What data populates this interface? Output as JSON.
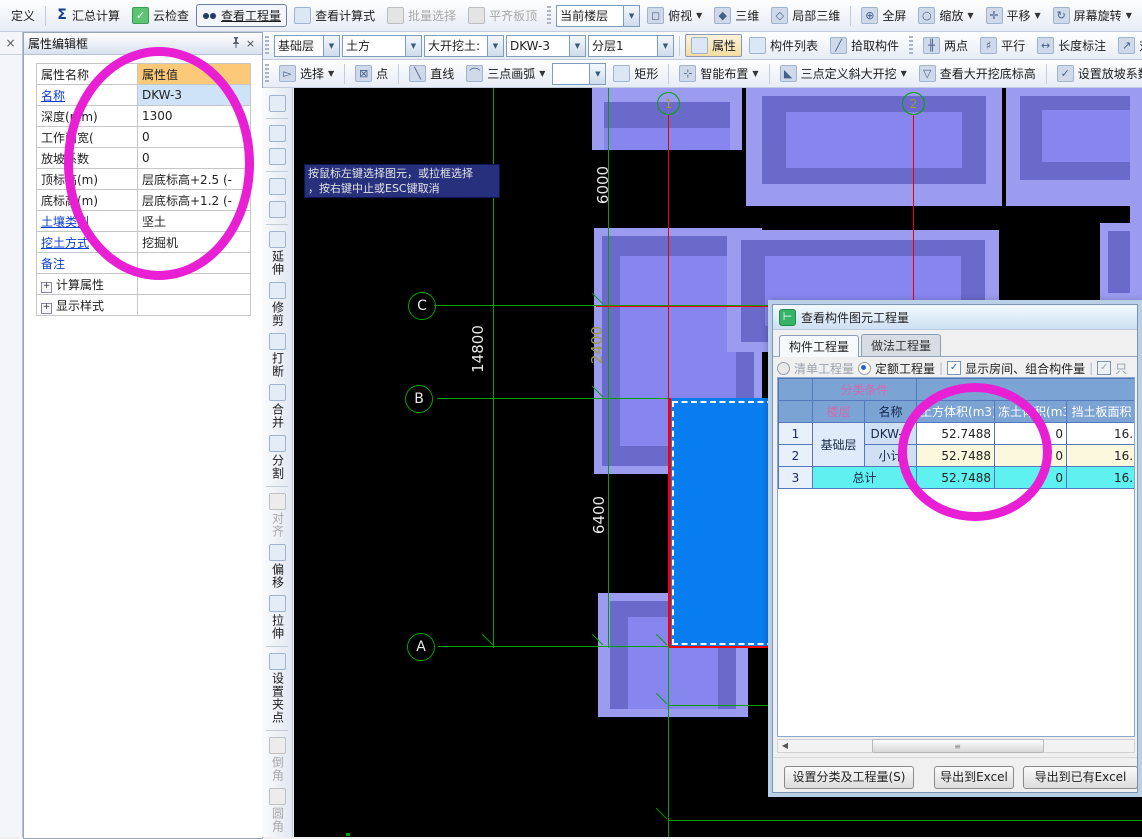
{
  "top_toolbar": {
    "define": "定义",
    "sum_calc": "汇总计算",
    "cloud_check": "云检查",
    "view_quantity": "查看工程量",
    "view_formula": "查看计算式",
    "batch_select": "批量选择",
    "align_slab_top": "平齐板顶",
    "current_floor": "当前楼层",
    "top_view": "俯视",
    "three_d": "三维",
    "partial_3d": "局部三维",
    "full_screen": "全屏",
    "zoom": "缩放",
    "pan": "平移",
    "screen_rotate": "屏幕旋转",
    "element_display": "构件图元显"
  },
  "toolbar2": {
    "floor_combo": "基础层",
    "category_combo": "土方",
    "type_combo": "大开挖土:",
    "name_combo": "DKW-3",
    "layer_combo": "分层1",
    "attribute": "属性",
    "element_list": "构件列表",
    "pick_element": "拾取构件",
    "two_points": "两点",
    "parallel": "平行",
    "length_dim": "长度标注",
    "align_dim": "对齐标注",
    "measure": "测量距"
  },
  "toolbar3": {
    "select": "选择",
    "point": "点",
    "line": "直线",
    "arc3": "三点画弧",
    "rect": "矩形",
    "smart_layout": "智能布置",
    "slope3": "三点定义斜大开挖",
    "view_bottom_elev": "查看大开挖底标高",
    "set_slope": "设置放坡系数",
    "set_work": "设置工"
  },
  "property_panel": {
    "title": "属性编辑框",
    "col_name": "属性名称",
    "col_value": "属性值",
    "rows": [
      {
        "name": "名称",
        "value": "DKW-3"
      },
      {
        "name": "深度(mm)",
        "value": "1300"
      },
      {
        "name": "工作面宽(",
        "value": "0"
      },
      {
        "name": "放坡系数",
        "value": "0"
      },
      {
        "name": "顶标高(m)",
        "value": "层底标高+2.5 (-"
      },
      {
        "name": "底标高(m)",
        "value": "层底标高+1.2 (-"
      },
      {
        "name": "土壤类别",
        "value": "坚土"
      },
      {
        "name": "挖土方式",
        "value": "挖掘机"
      },
      {
        "name": "备注",
        "value": ""
      }
    ],
    "groups": [
      "计算属性",
      "显示样式"
    ]
  },
  "side_toolbar": {
    "labels": [
      "延伸",
      "修剪",
      "打断",
      "合并",
      "分割",
      "对齐",
      "偏移",
      "拉伸",
      "设置夹点",
      "倒角",
      "圆角"
    ]
  },
  "canvas": {
    "axis_top": [
      "1",
      "2"
    ],
    "axis_left": [
      "C",
      "B",
      "A"
    ],
    "dims": {
      "d6000": "6000",
      "d14800": "14800",
      "d2400": "2400",
      "d6400": "6400"
    },
    "tooltip_line1": "按鼠标左键选择图元，或拉框选择",
    "tooltip_line2": "，按右键中止或ESC键取消"
  },
  "dialog": {
    "title": "查看构件图元工程量",
    "tab1": "构件工程量",
    "tab2": "做法工程量",
    "radio1": "清单工程量",
    "radio2": "定额工程量",
    "check1": "显示房间、组合构件量",
    "check2": "只",
    "table": {
      "group_header": "分类条件",
      "h_floor": "楼层",
      "h_name": "名称",
      "h_v1": "土方体积(m3)",
      "h_v2": "冻土体积(m3)",
      "h_v3": "挡土板面积",
      "rows": [
        {
          "idx": "1",
          "floor": "基础层",
          "name": "DKW-3",
          "v1": "52.7488",
          "v2": "0",
          "v3": "16."
        },
        {
          "idx": "2",
          "name": "小计",
          "v1": "52.7488",
          "v2": "0",
          "v3": "16."
        },
        {
          "idx": "3",
          "name": "总计",
          "v1": "52.7488",
          "v2": "0",
          "v3": "16."
        }
      ]
    },
    "buttons": {
      "set_class": "设置分类及工程量(S)",
      "export_excel": "导出到Excel",
      "export_existing": "导出到已有Excel"
    }
  }
}
